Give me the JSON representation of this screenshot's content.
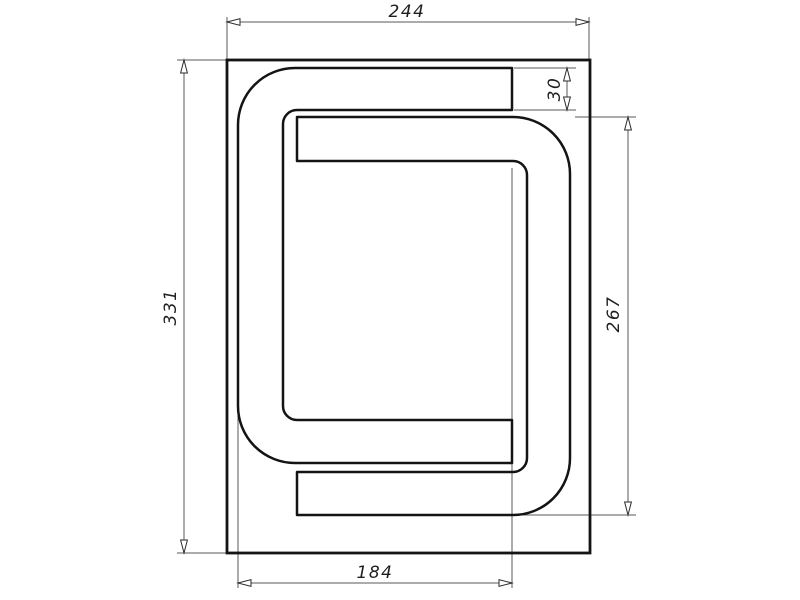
{
  "drawing": {
    "kind": "technical-drawing",
    "subject": "rectangular plate with two interlocking C-shaped channels (serpentine groove)",
    "background": "#ffffff",
    "outline_color": "#141414",
    "dimension_color": "#5a5a5a",
    "dims": {
      "overall_width": "244",
      "overall_height": "331",
      "channel_width": "30",
      "inner_channel_height": "267",
      "bottom_span": "184"
    }
  }
}
